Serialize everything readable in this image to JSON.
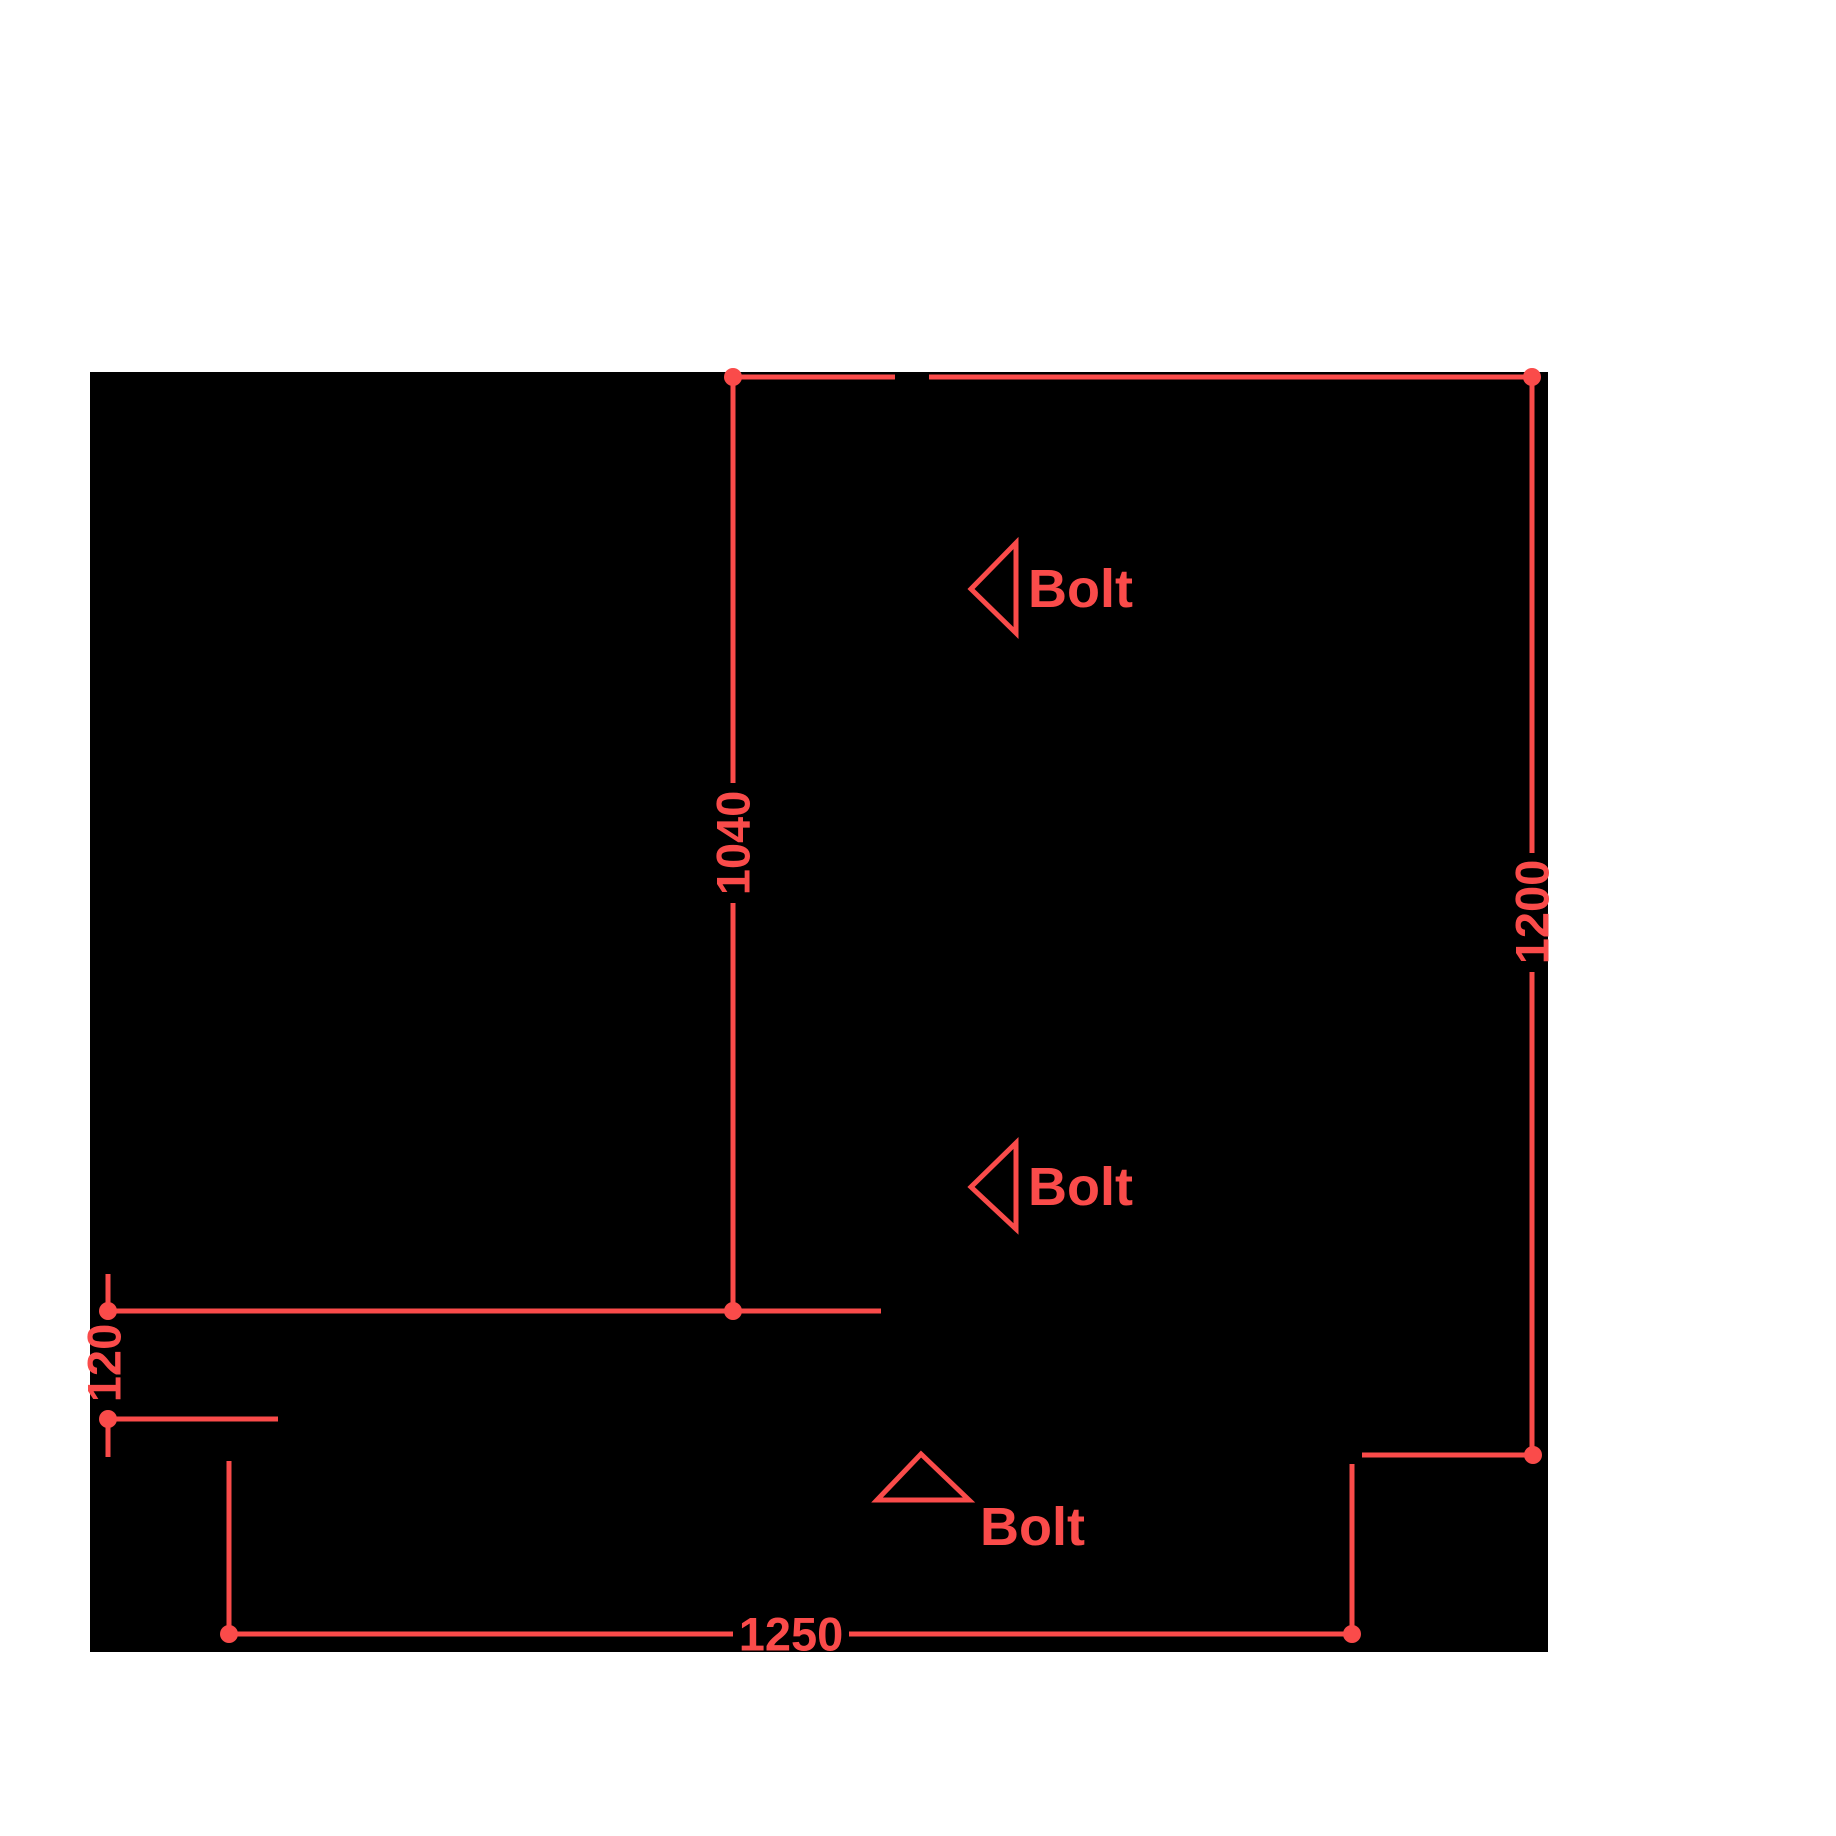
{
  "colors": {
    "background": "#ffffff",
    "part_silhouette": "#000000",
    "dimension_red": "#fa4b4a"
  },
  "dimensions": {
    "inner_height": {
      "value": "1040"
    },
    "overall_height": {
      "value": "1200"
    },
    "left_offset": {
      "value": "120"
    },
    "bottom_width": {
      "value": "1250"
    }
  },
  "annotations": {
    "bolt_upper": {
      "label": "Bolt"
    },
    "bolt_middle": {
      "label": "Bolt"
    },
    "bolt_lower": {
      "label": "Bolt"
    }
  }
}
